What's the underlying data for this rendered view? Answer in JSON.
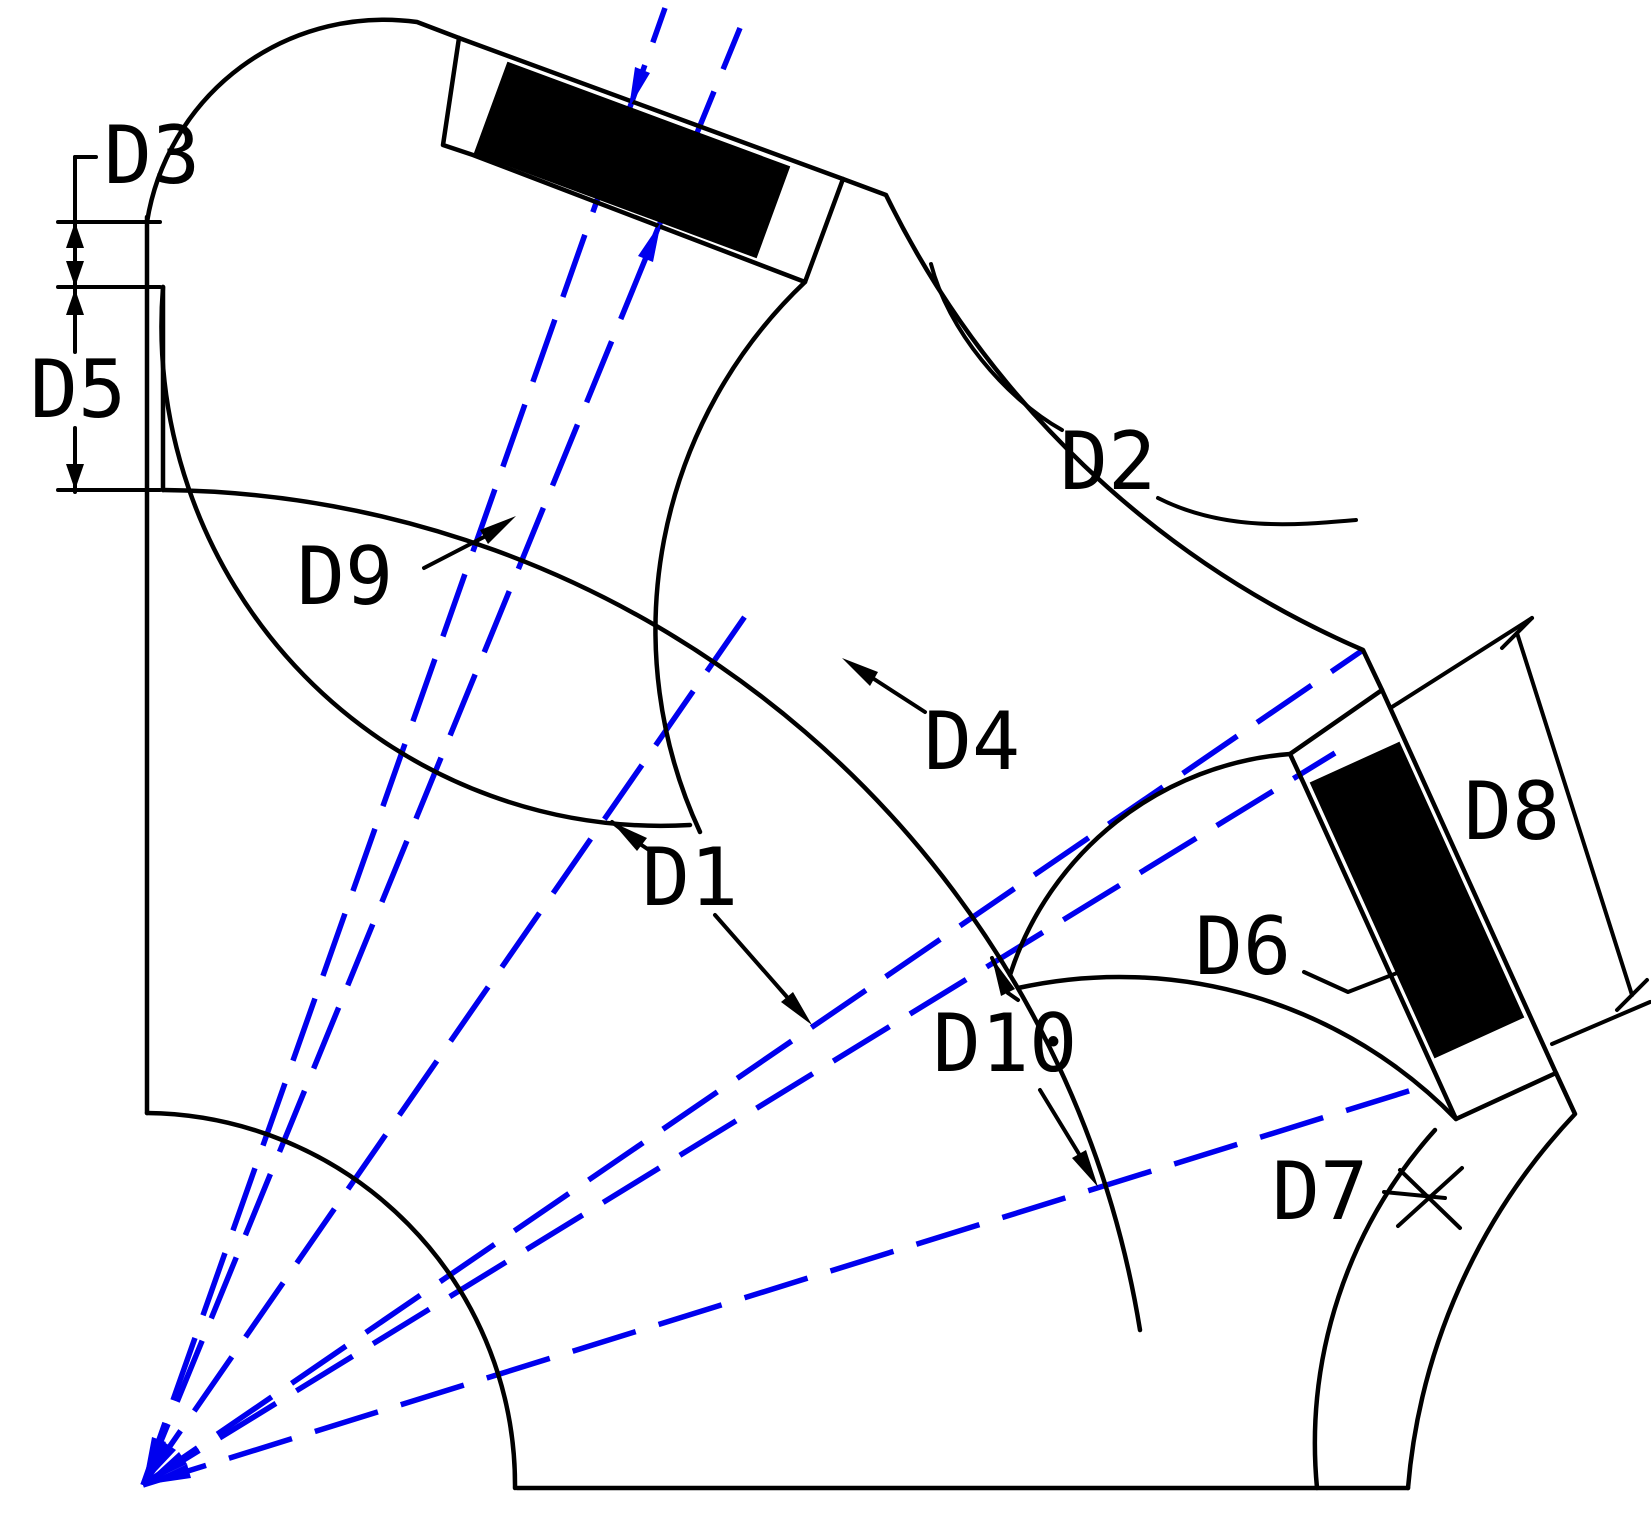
{
  "figure": {
    "kind": "rotor-lamination-quarter-section-drawing",
    "description_visible_elements": "quarter sector of motor rotor with two black permanent magnets, scalloped pole segments, dashed construction lines from center origin, dimension callouts"
  },
  "colors": {
    "outline": "#000000",
    "construction_line": "#0000ee",
    "magnet_fill": "#000000",
    "background": "#ffffff"
  },
  "labels": [
    {
      "id": "D3",
      "text": "D3"
    },
    {
      "id": "D5",
      "text": "D5"
    },
    {
      "id": "D9",
      "text": "D9"
    },
    {
      "id": "D2",
      "text": "D2"
    },
    {
      "id": "D4",
      "text": "D4"
    },
    {
      "id": "D1",
      "text": "D1"
    },
    {
      "id": "D10",
      "text": "D10"
    },
    {
      "id": "D6",
      "text": "D6"
    },
    {
      "id": "D8",
      "text": "D8"
    },
    {
      "id": "D7",
      "text": "D7"
    }
  ]
}
